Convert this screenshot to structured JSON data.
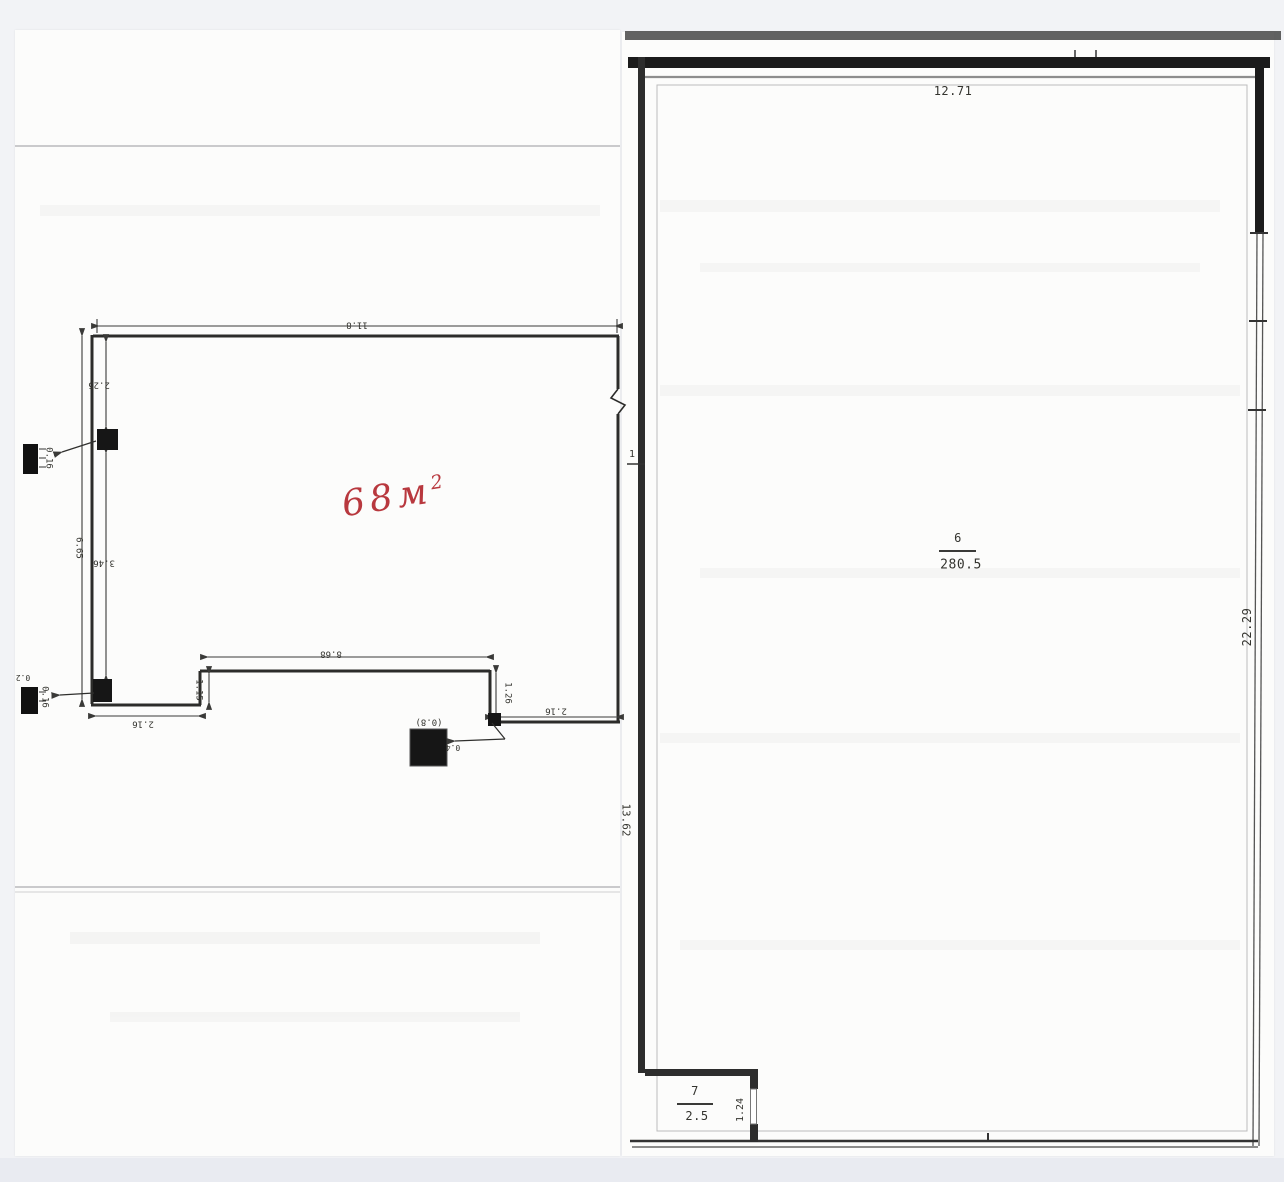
{
  "left_plan": {
    "handwritten_area": {
      "value": "68",
      "unit": "м",
      "exponent": "2"
    },
    "dimensions": {
      "top_width": "11.8",
      "side_total": "6.65",
      "side_upper": "2.25",
      "side_lower": "3.46",
      "inner_width": "8.68",
      "step_left_height": "1.15",
      "step_right_height": "1.26",
      "bottom_left_width": "2.16",
      "bottom_right_width": "2.16"
    },
    "detail_labels": {
      "top_column_size": "0.16",
      "bottom_column_offset": "0.2",
      "bottom_column_size": "0.16",
      "center_column_size": "(0.8)",
      "center_column_offset": "0.4"
    }
  },
  "right_plan": {
    "dimensions": {
      "top_width": "12.71",
      "right_height": "22.29",
      "left_height": "13.62",
      "left_wall_opening": "1",
      "room7_door_width": "1.24"
    },
    "room6": {
      "number": "6",
      "area": "280.5"
    },
    "room7": {
      "number": "7",
      "area": "2.5"
    }
  },
  "colors": {
    "ink": "#2e2e2e",
    "annotation_red": "#b8383e",
    "paper": "#fcfcfb",
    "background": "#f2f3f6"
  }
}
